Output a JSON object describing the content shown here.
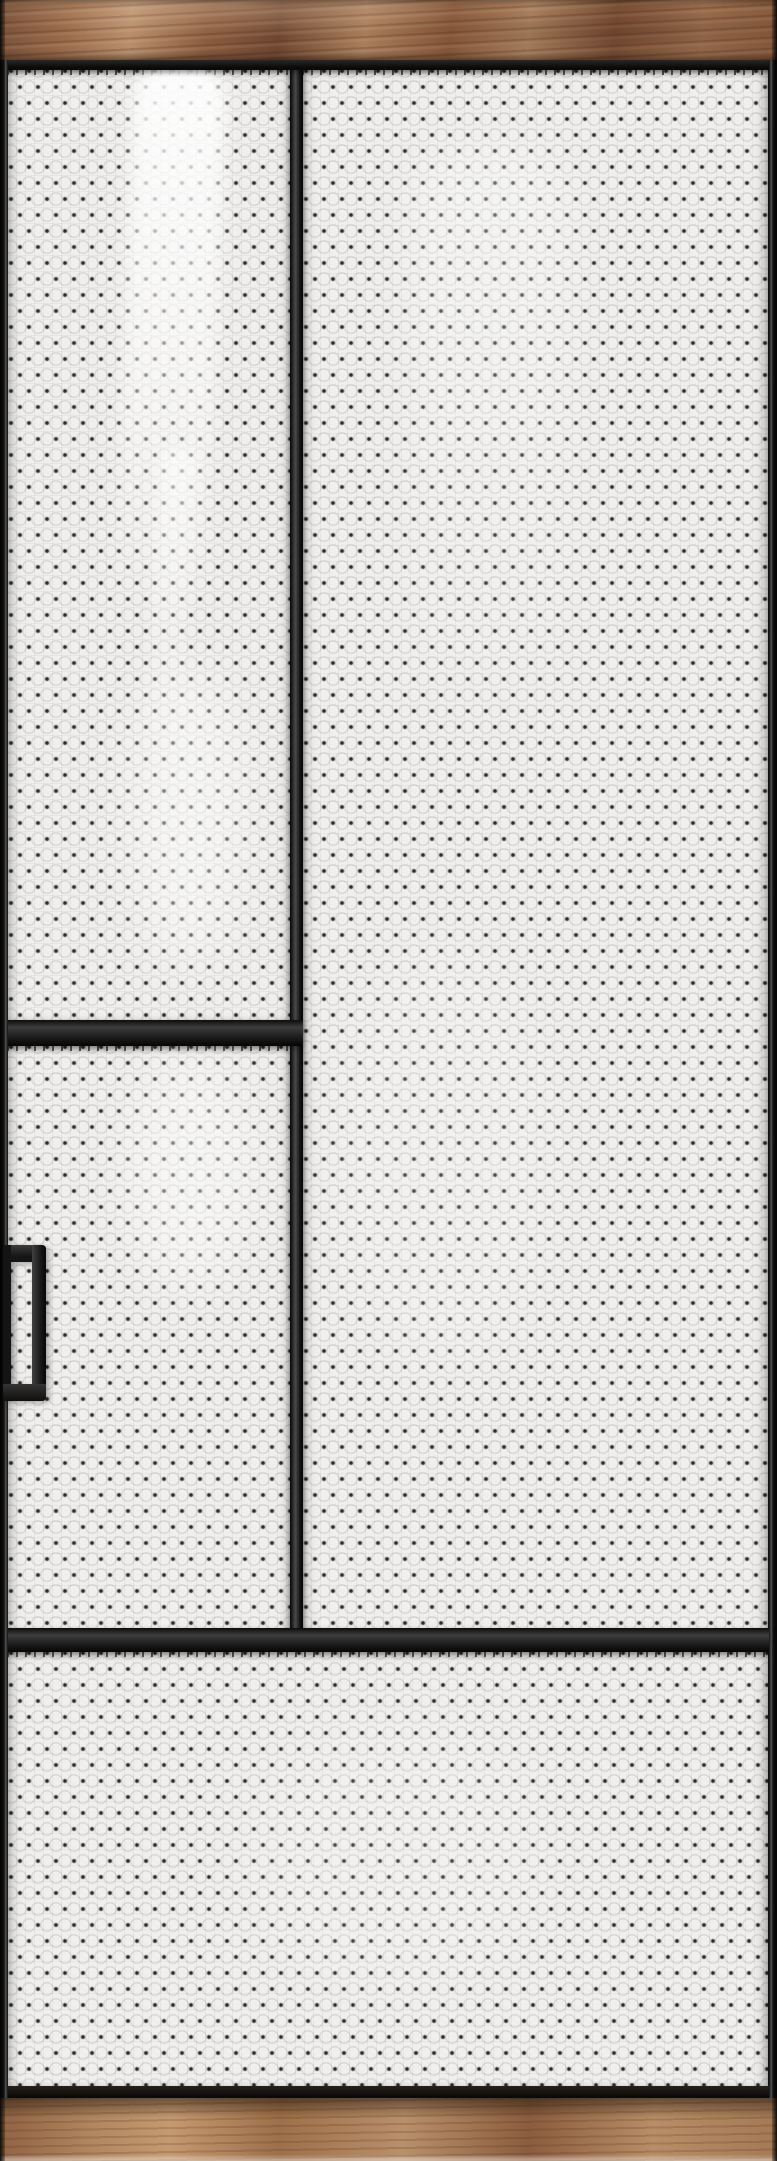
{
  "scene": {
    "type": "product-photo",
    "subject": "black-framed glass door with patterned textured glass, walnut wood transom and base",
    "orientation": "tall portrait"
  },
  "palette": {
    "frame_black": "#141414",
    "frame_highlight": "#4e4e4e",
    "glass_base": "#f0efed",
    "glass_dot": "#2d2d2d",
    "glass_emboss_line": "#8c8c8c",
    "reflection_white": "#ffffff",
    "wood_header_mid": "#96684a",
    "wood_header_light": "#b88f6c",
    "wood_header_dark": "#6f4730",
    "wood_base_mid": "#a87c58",
    "wood_base_light": "#c49a70",
    "wood_base_dark": "#8a5d3e"
  },
  "parts": {
    "wood_header": "wood transom panel",
    "wood_base": "wood base sill",
    "top_rail": "top frame rail",
    "bottom_rail": "bottom frame rail",
    "mid_rail": "full-width middle rail",
    "left_divider": "left panel divider rail",
    "mullion": "vertical mullion",
    "left_stile": "left frame stile",
    "right_stile": "right frame stile",
    "handle": "vertical pull handle",
    "glass_upper_left": "upper-left textured glass panel",
    "glass_mid_left": "middle-left textured glass panel",
    "glass_right": "right textured glass panel",
    "glass_bottom": "bottom full-width textured glass panel"
  },
  "pattern": {
    "style": "staggered dot grid with embossed floral circles",
    "dot_spacing_px": 18,
    "row_spacing_px": 16
  }
}
